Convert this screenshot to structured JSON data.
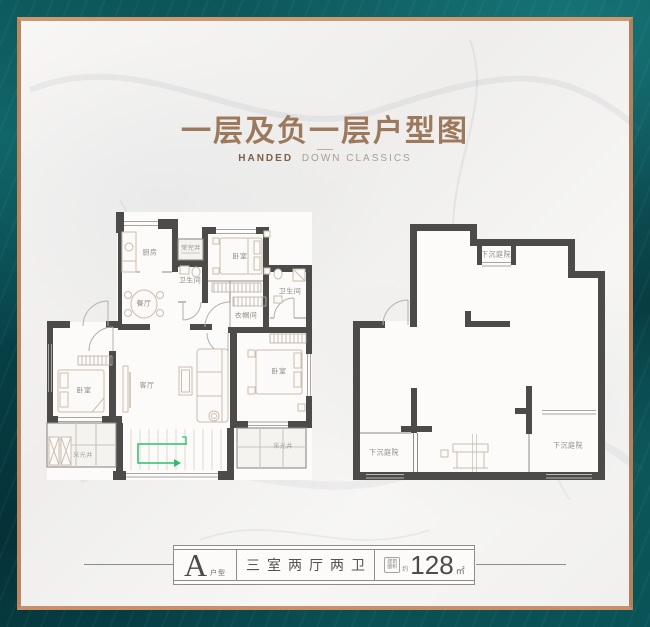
{
  "header": {
    "title": "一层及负一层户型图",
    "subtitle_bold": "HANDED",
    "subtitle_rest": "DOWN CLASSICS"
  },
  "floor_plans": {
    "first_floor": {
      "rooms": [
        {
          "name": "kitchen",
          "label": "厨房"
        },
        {
          "name": "light-well-north",
          "label": "采光井"
        },
        {
          "name": "bathroom-main",
          "label": "卫生间"
        },
        {
          "name": "bedroom-north",
          "label": "卧室"
        },
        {
          "name": "bathroom-second",
          "label": "卫生间"
        },
        {
          "name": "cloakroom",
          "label": "衣帽间"
        },
        {
          "name": "dining-room",
          "label": "餐厅"
        },
        {
          "name": "living-room",
          "label": "客厅"
        },
        {
          "name": "bedroom-west",
          "label": "卧室"
        },
        {
          "name": "bedroom-east",
          "label": "卧室"
        },
        {
          "name": "light-well-southwest",
          "label": "采光井"
        },
        {
          "name": "light-well-southeast",
          "label": "采光井"
        }
      ]
    },
    "basement": {
      "rooms": [
        {
          "name": "sunken-courtyard-north",
          "label": "下沉庭院"
        },
        {
          "name": "sunken-courtyard-southwest",
          "label": "下沉庭院"
        },
        {
          "name": "sunken-courtyard-southeast",
          "label": "下沉庭院"
        }
      ]
    }
  },
  "footer": {
    "unit_letter": "A",
    "unit_suffix": "户型",
    "layout_text": "三室两厅两卫",
    "area_label_line1": "建筑",
    "area_label_line2": "面积",
    "area_approx": "约",
    "area_value": "128",
    "area_unit": "㎡"
  },
  "colors": {
    "background_teal": "#07454b",
    "card_marble": "#f4f3f1",
    "frame_copper": "#c08a66",
    "title_copper": "#9c795c",
    "wall_dark": "#4c4b49",
    "stair_arrow_green": "#2fbf6b"
  }
}
